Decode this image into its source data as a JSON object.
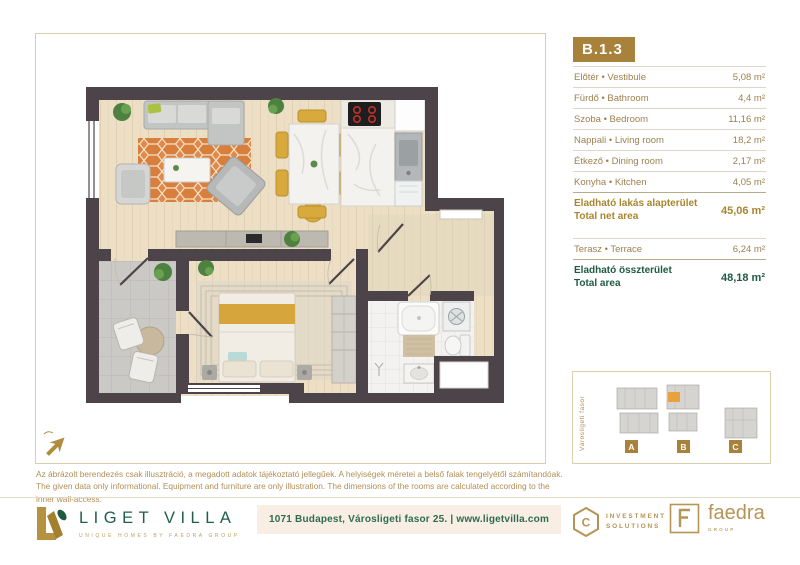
{
  "unit_badge": "B.1.3",
  "room_table": {
    "rows": [
      {
        "label": "Előtér • Vestibule",
        "area": "5,08 m²"
      },
      {
        "label": "Fürdő • Bathroom",
        "area": "4,4 m²"
      },
      {
        "label": "Szoba • Bedroom",
        "area": "11,16 m²"
      },
      {
        "label": "Nappali • Living room",
        "area": "18,2 m²"
      },
      {
        "label": "Étkező • Dining room",
        "area": "2,17 m²"
      },
      {
        "label": "Konyha • Kitchen",
        "area": "4,05 m²"
      }
    ],
    "net_total": {
      "label_hu": "Eladható lakás alapterület",
      "label_en": "Total net area",
      "area": "45,06 m²"
    },
    "terrace_row": {
      "label": "Terasz • Terrace",
      "area": "6,24 m²"
    },
    "grand_total": {
      "label_hu": "Eladható összterület",
      "label_en": "Total area",
      "area": "48,18 m²"
    }
  },
  "site_plan": {
    "street_label": "Városligeti fasor",
    "buildings": [
      "A",
      "B",
      "C"
    ],
    "highlighted_building": "B"
  },
  "disclaimer": {
    "hu": "Az ábrázolt berendezés csak illusztráció, a megadott adatok tájékoztató jellegűek. A helyiségek méretei a belső falak tengelyétől számítandóak.",
    "en": "The given data only informational. Equipment and furniture are only illustration. The dimensions of the rooms are calculated according to the inner wall-access."
  },
  "footer": {
    "brand": "LIGET VILLA",
    "tagline": "UNIQUE HOMES BY FAEDRA GROUP",
    "address": "1071 Budapest, Városligeti fasor 25. | www.ligetvilla.com",
    "partner_investment": {
      "line1": "INVESTMENT",
      "line2": "SOLUTIONS",
      "icon_letter": "C"
    },
    "partner_faedra": {
      "name": "faedra",
      "sub": "GROUP"
    }
  },
  "colors": {
    "gold": "#a8813a",
    "green": "#1e5b40",
    "wall": "#4d4449",
    "wood": "#ecdfc6",
    "terrace": "#cbc9c5",
    "rug_orange": "#dd853f",
    "site_highlight": "#e9a23b"
  }
}
